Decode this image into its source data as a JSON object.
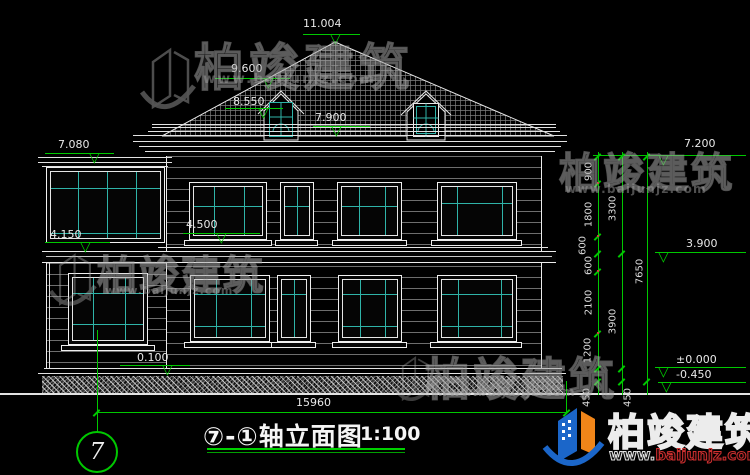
{
  "title_bar": {
    "title": "⑦-①轴立面图",
    "scale": "1:100",
    "axis_number": "7"
  },
  "elevations": {
    "ridge": "11.004",
    "dormer_peak": "9.600",
    "dormer_sill": "8.550",
    "eave": "7.900",
    "sunroom_top": "7.080",
    "sill_2f": "4.500",
    "sunroom_floor": "4.150",
    "plinth": "0.100",
    "right_top": "7.200",
    "right_floor2": "3.900",
    "right_zero": "±0.000",
    "right_foundation": "-0.450"
  },
  "dimensions": {
    "total_width": "15960",
    "chain_inner": [
      "900",
      "1800",
      "600",
      "600",
      "2100",
      "1200",
      "450"
    ],
    "chain_mid": [
      "3300",
      "3900",
      "450"
    ],
    "chain_total": [
      "7650"
    ]
  },
  "watermark": {
    "brand": "柏竣建筑",
    "url": "www.baijunjz.com",
    "url_prefix": "www.",
    "url_domain": "baijunjz.com"
  },
  "icons": {
    "elevation_triangle": "▽"
  },
  "colors": {
    "background": "#000000",
    "line_white": "#e8e8e8",
    "dim_green": "#00c800",
    "glass_cyan": "#2fb3a8",
    "logo_blue": "#1b66c9",
    "logo_orange": "#f08519",
    "logo_red": "#d03030"
  }
}
